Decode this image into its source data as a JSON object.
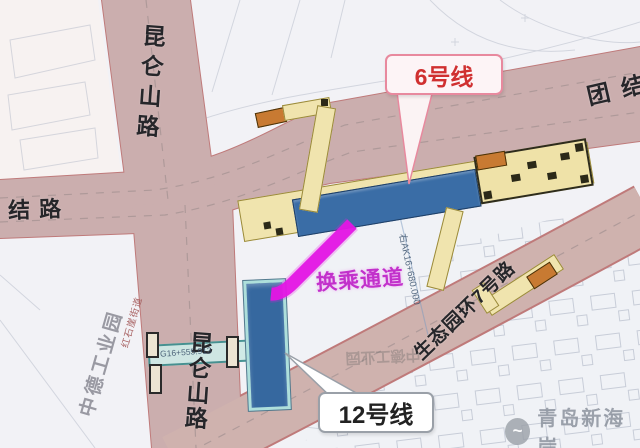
{
  "callouts": {
    "line6_label": "6号线",
    "line12_label": "12号线",
    "transfer_label": "换乘通道"
  },
  "roads": {
    "kunlun_top": "昆仑山路",
    "kunlun_bottom": "昆仑山路",
    "tuanjie_left": "结路",
    "tuanjie_right": "团结",
    "eco_ring7": "生态园环7号路"
  },
  "map_texts": {
    "industrial_park": "中德工业园",
    "subdistrict": "红石崖街道",
    "chainage_ak": "右AK16+680.000",
    "chainage_corridor": "G16+555.913",
    "upside_down_label": "中德工业园"
  },
  "watermark": {
    "logo_glyph": "~",
    "text": "青岛新海岸"
  },
  "colors": {
    "road_fill": "#cbaeae",
    "road_edge": "#bf7a7a",
    "station_band_yellow": "#f0e4ae",
    "station_box_blue": "#3a6da6",
    "corridor_teal": "#cfeae6",
    "transfer_magenta": "#e416e4",
    "entrance_orange": "#c87a32",
    "line6_callout_border": "#e8899e",
    "line6_callout_text": "#d03030"
  }
}
